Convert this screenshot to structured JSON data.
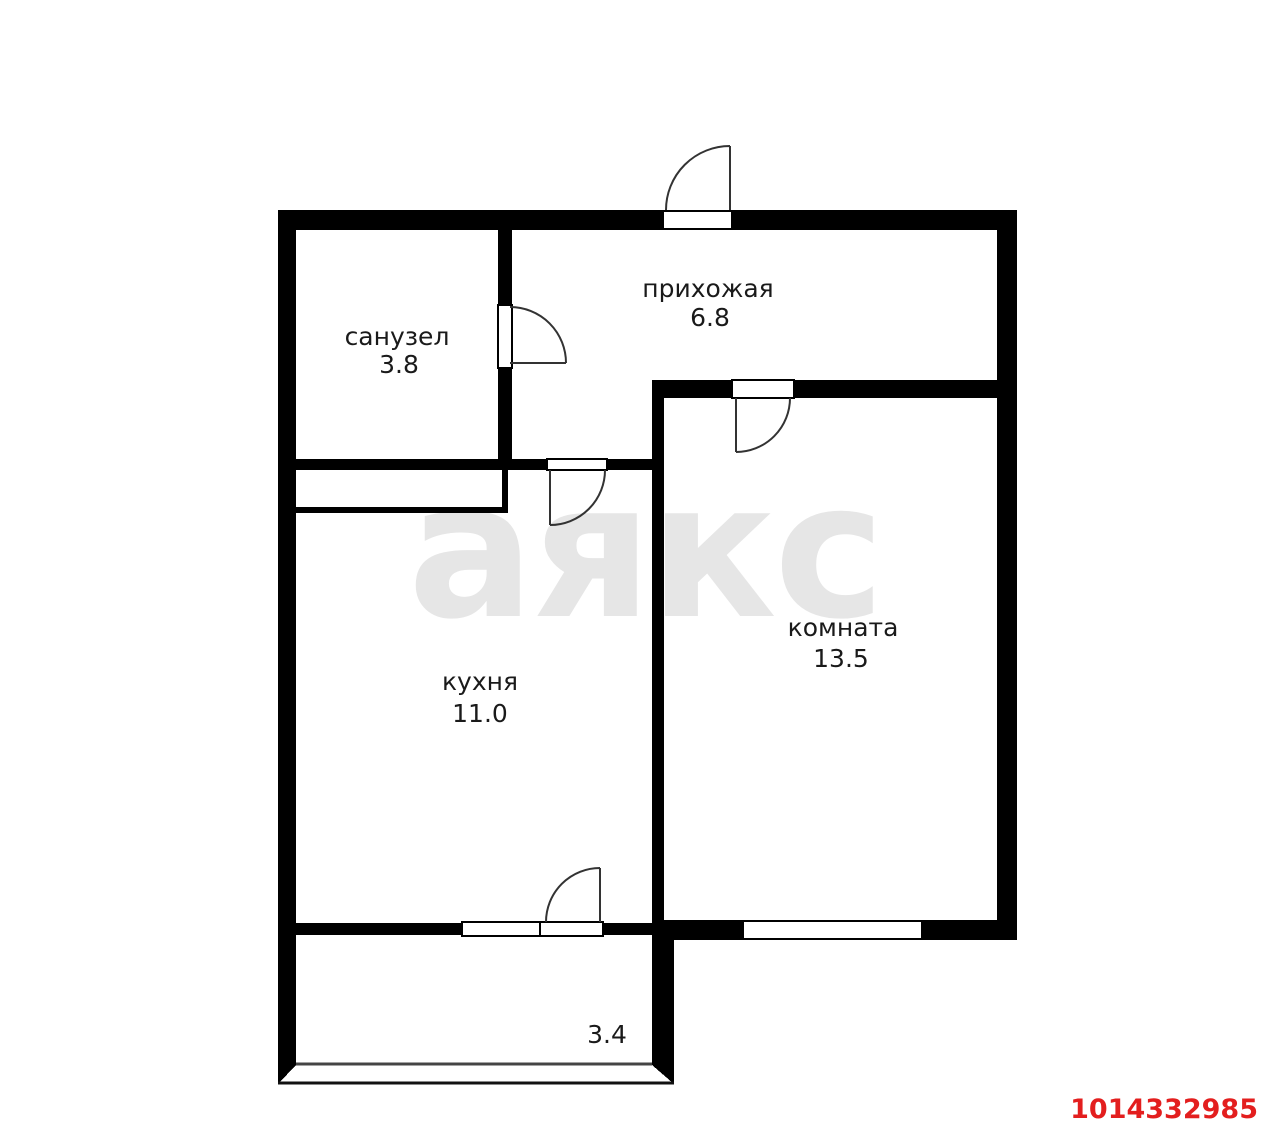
{
  "watermark": "аякс",
  "listing_id": "1014332985",
  "rooms": {
    "bathroom": {
      "label": "санузел",
      "area": "3.8"
    },
    "hallway": {
      "label": "прихожая",
      "area": "6.8"
    },
    "kitchen": {
      "label": "кухня",
      "area": "11.0"
    },
    "living": {
      "label": "комната",
      "area": "13.5"
    },
    "balcony": {
      "area": "3.4"
    }
  },
  "colors": {
    "wall": "#000000",
    "background": "#ffffff",
    "watermark_gray": "#e6e6e6",
    "label_text": "#1a1a1a",
    "door_stroke": "#333333",
    "listing_red": "#e31e1e"
  }
}
